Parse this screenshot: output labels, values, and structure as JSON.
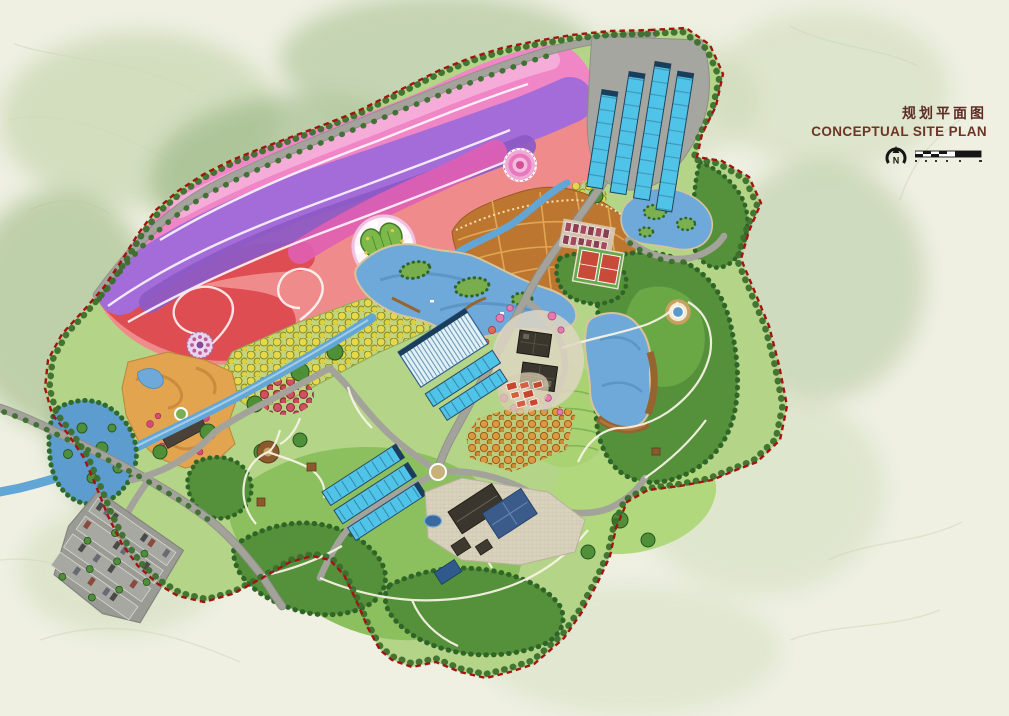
{
  "header": {
    "title_cn": "规划平面图",
    "title_en": "CONCEPTUAL SITE PLAN",
    "title_cn_color": "#5d2d24",
    "title_en_color": "#6e3526"
  },
  "compass": {
    "label": "N",
    "icon": "north-arrow-icon"
  },
  "scale_bar": {
    "icon": "scale-bar-icon",
    "segments": 5
  },
  "palette": {
    "canvas": "#eff0e2",
    "wash_green_light": "#ccd9b6",
    "wash_green": "#a9c292",
    "wash_green_dark": "#8fb07a",
    "site_base": "#b4d488",
    "hill_green": "#8cc05e",
    "hill_green_light": "#b2d87e",
    "forest": "#55903a",
    "forest_dark": "#2f6628",
    "flower_salmon": "#ef8b8b",
    "flower_red": "#de4d52",
    "flower_pink": "#f186c7",
    "flower_pink_light": "#f5aed9",
    "flower_purple": "#a46cd8",
    "flower_violet": "#8d5bc5",
    "flower_magenta": "#e05fb3",
    "orchard_base": "#c3d47e",
    "orchard_yellow": "#e6d84a",
    "terrace_orange": "#bd7630",
    "terrace_cell": "#e2aa55",
    "garden_tan": "#e2a44f",
    "water": "#6fa9d9",
    "water_dark": "#4d86b8",
    "stream": "#62a6d6",
    "greenhouse": "#4fc4e8",
    "greenhouse_dark": "#1b3d5c",
    "pavement": "#a6a6a0",
    "road": "#a3a39b",
    "path_white": "#f7f3e4",
    "boundary_red": "#a21414",
    "heart_green": "#7db84b",
    "court_red": "#c84a38",
    "roof_dark": "#3a362e",
    "roof_navy": "#3b5c8a",
    "village_roof": "#c5472e",
    "dorm_roof": "#a34a5e",
    "boardwalk": "#96642f",
    "parking": "#9b9b95",
    "pink_tree": "#e87ab2"
  }
}
